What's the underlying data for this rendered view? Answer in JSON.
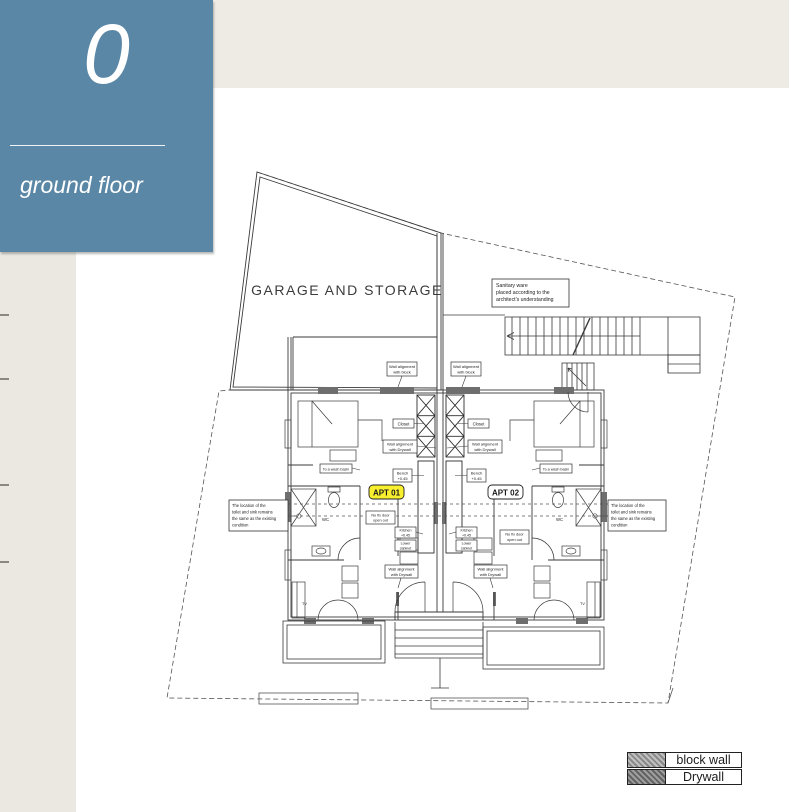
{
  "page": {
    "background": "#ffffff",
    "top_band_color": "#edebe4",
    "left_strip_color": "#ebe8e2"
  },
  "title_block": {
    "floor_number": "0",
    "floor_label": "ground floor",
    "bg_color": "#5b87a6",
    "text_color": "#ffffff"
  },
  "plan": {
    "garage_label": "GARAGE AND STORAGE",
    "apartment_1_label": "APT 01",
    "apartment_2_label": "APT 02",
    "apartment_1_highlight_color": "#f8ef2f",
    "wc_label": "WC",
    "tv_label": "TV",
    "notes": {
      "sanitary": {
        "lines": [
          "Sanitary ware",
          "placed according to the",
          "architect's understanding"
        ]
      },
      "toilet": {
        "lines": [
          "The location of the",
          "toilet and sink remains",
          "the same as the existing",
          "condition"
        ]
      }
    },
    "labels": {
      "wall_block": {
        "lines": [
          "Wall alignment",
          "with block"
        ]
      },
      "wall_drywall": {
        "lines": [
          "Wall alignment",
          "with Drywall"
        ]
      },
      "closet": "Closet",
      "bench": {
        "lines": [
          "Bench",
          "+0.45"
        ]
      },
      "washbasin": "To a wash basin",
      "no_fix_door": {
        "lines": [
          "No fix door",
          "open out"
        ]
      },
      "kitchen": {
        "lines": [
          "Kitchen",
          "+0.45"
        ]
      },
      "lower_cabinet": {
        "lines": [
          "Lower",
          "cabinet"
        ]
      }
    }
  },
  "legend": {
    "rows": [
      {
        "label": "block wall",
        "swatch_color": "#a7a7a7"
      },
      {
        "label": "Drywall",
        "swatch_color": "#787878"
      }
    ]
  }
}
